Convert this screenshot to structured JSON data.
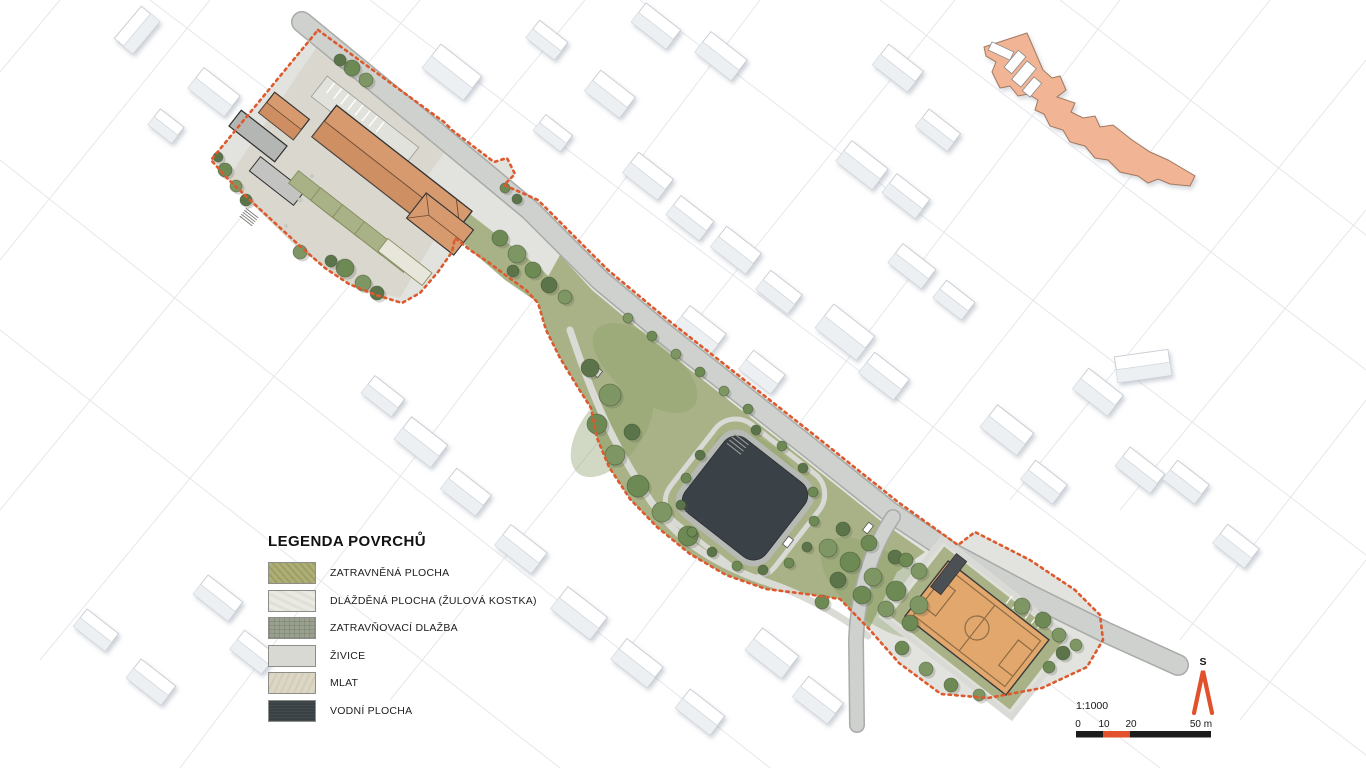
{
  "legend": {
    "title": "LEGENDA POVRCHŮ",
    "items": [
      {
        "label": "ZATRAVNĚNÁ PLOCHA",
        "color": "#a8aa6e",
        "texture": "tx-grass"
      },
      {
        "label": "DLÁŽDĚNÁ PLOCHA (ŽULOVÁ KOSTKA)",
        "color": "#eaeae3",
        "texture": "tx-pave"
      },
      {
        "label": "ZATRAVŇOVACÍ DLAŽBA",
        "color": "#99a08e",
        "texture": "tx-grid"
      },
      {
        "label": "ŽIVICE",
        "color": "#d8d9d3",
        "texture": ""
      },
      {
        "label": "MLAT",
        "color": "#dcd7c5",
        "texture": "tx-mlat"
      },
      {
        "label": "VODNÍ PLOCHA",
        "color": "#3a4145",
        "texture": "tx-water"
      }
    ]
  },
  "scale": {
    "ratio": "1:1000",
    "ticks": [
      "0",
      "10",
      "20",
      "50 m"
    ],
    "bar_colors": [
      "#1c1c1c",
      "#e0512c",
      "#1c1c1c"
    ]
  },
  "north": {
    "label": "S"
  },
  "colors": {
    "boundary": "#dc5a2e",
    "water": "#3a4147",
    "grass": "#a8b286",
    "grassdark": "#8da06b",
    "field": "#e2a76c",
    "fieldline": "#8d6c44",
    "roof": "#d69a6e",
    "roofshade": "#c9875a",
    "keyplan": "#f1b495",
    "road": "#cfd1ce",
    "roadedge": "#a9aba8",
    "paving": "#e2e3de",
    "mlat": "#dad8ce",
    "accent": "#e0512c"
  }
}
